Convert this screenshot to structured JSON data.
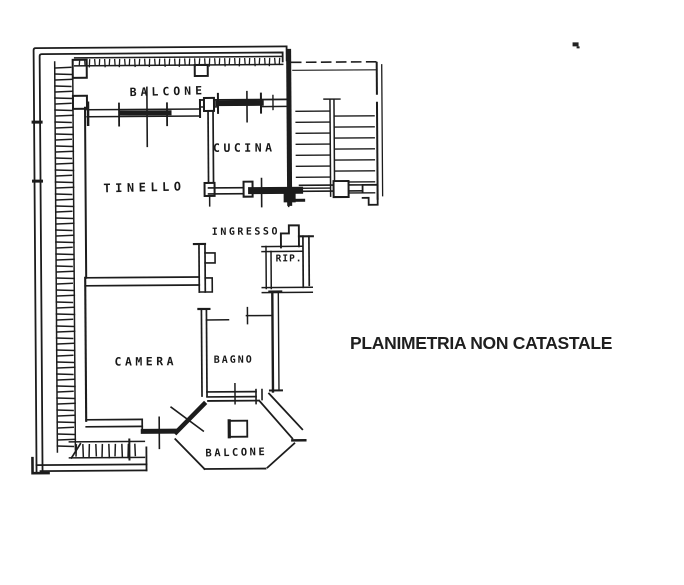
{
  "plan": {
    "ink_color": "#1c1c1c",
    "rooms": {
      "balcone_top": "BALCONE",
      "cucina": "CUCINA",
      "tinello": "TINELLO",
      "ingresso": "INGRESSO",
      "rip": "RIP.",
      "camera": "CAMERA",
      "bagno": "BAGNO",
      "balcone_bottom": "BALCONE"
    }
  },
  "caption": {
    "text": "PLANIMETRIA NON CATASTALE",
    "color": "#1f1f1f"
  }
}
